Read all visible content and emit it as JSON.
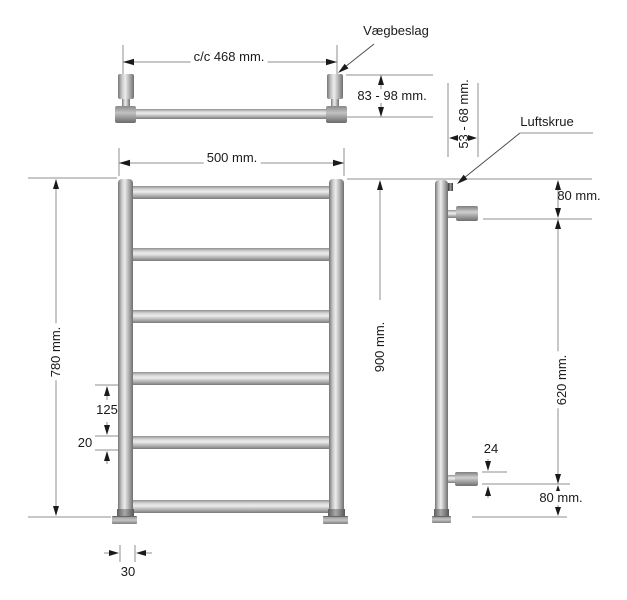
{
  "drawing_title": "Towel radiator dimensional drawing",
  "colors": {
    "background": "#ffffff",
    "dimension_line": "#8f8f8f",
    "text": "#1a1a1a",
    "metal_light": "#ececec",
    "metal_dark": "#6f6f6f"
  },
  "top_view": {
    "center_distance": "c/c 468 mm.",
    "wall_bracket_label": "Vægbeslag",
    "mounting_depth": "83 - 98 mm."
  },
  "front_view": {
    "width": "500 mm.",
    "height": "780 mm.",
    "mounting_height": "900 mm.",
    "rung_spacing": "125",
    "rung_diameter": "20",
    "tube_diameter": "30"
  },
  "side_view": {
    "wall_clearance": "53 - 68 mm.",
    "air_screw_label": "Luftskrue",
    "top_bracket_offset": "80 mm.",
    "bracket_spacing": "620 mm.",
    "bracket_diameter": "24",
    "bottom_bracket_offset": "80 mm."
  }
}
